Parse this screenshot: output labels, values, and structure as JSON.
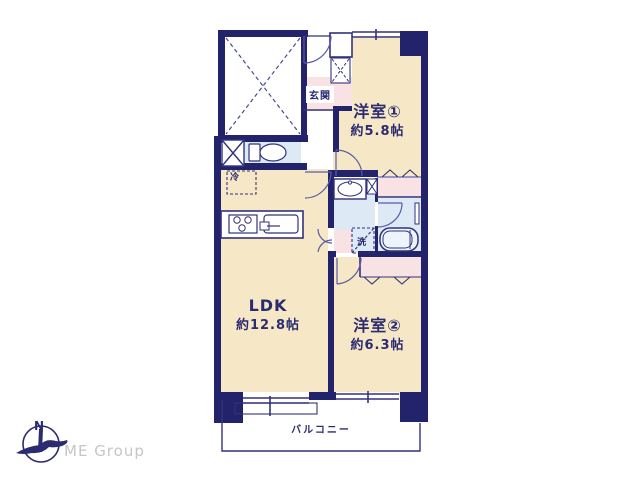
{
  "plan_type": "floor-plan",
  "colors": {
    "wall_navy": "#23236b",
    "line_navy": "#32327c",
    "room_cream": "#f6e8c6",
    "wet_area_blue": "#dde9f5",
    "closet_pink": "#f9e2e3",
    "logo_gray": "#c6c6c6"
  },
  "rooms": {
    "room1": {
      "name": "洋室①",
      "size": "約5.8帖"
    },
    "ldk": {
      "name": "LDK",
      "size": "約12.8帖"
    },
    "room2": {
      "name": "洋室②",
      "size": "約6.3帖"
    }
  },
  "labels": {
    "entrance": "玄関",
    "balcony": "バルコニー",
    "refrigerator": "冷",
    "washer": "洗"
  },
  "branding": {
    "company": "ME Group",
    "compass_north": "N"
  }
}
